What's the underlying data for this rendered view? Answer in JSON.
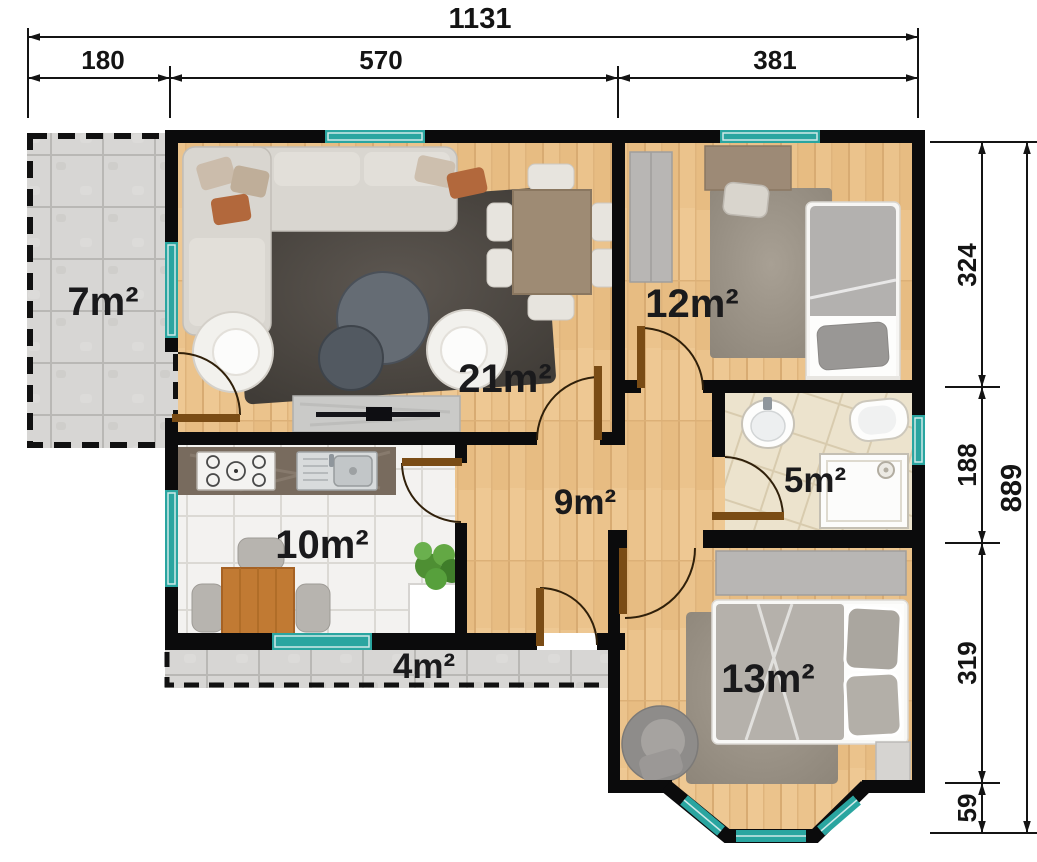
{
  "plan": {
    "dimensions_top": {
      "total": "1131",
      "segments": [
        "180",
        "570",
        "381"
      ]
    },
    "dimensions_right": {
      "total": "889",
      "segments": [
        "324",
        "188",
        "319",
        "59"
      ]
    },
    "rooms": [
      {
        "name": "terrace-upper",
        "area": "7m²"
      },
      {
        "name": "living-room",
        "area": "21m²"
      },
      {
        "name": "bedroom-small",
        "area": "12m²"
      },
      {
        "name": "bathroom",
        "area": "5m²"
      },
      {
        "name": "hallway",
        "area": "9m²"
      },
      {
        "name": "kitchen",
        "area": "10m²"
      },
      {
        "name": "terrace-lower",
        "area": "4m²"
      },
      {
        "name": "bedroom-large",
        "area": "13m²"
      }
    ],
    "colors": {
      "wall": "#0b0b0c",
      "window": "#2aa5a0",
      "wood_floor": "#ebc38c",
      "terrace_tile": "#d7d6d4",
      "kitchen_tile": "#f3f2f0",
      "bath_tile": "#ece3cd",
      "door": "#7a4c15"
    }
  }
}
